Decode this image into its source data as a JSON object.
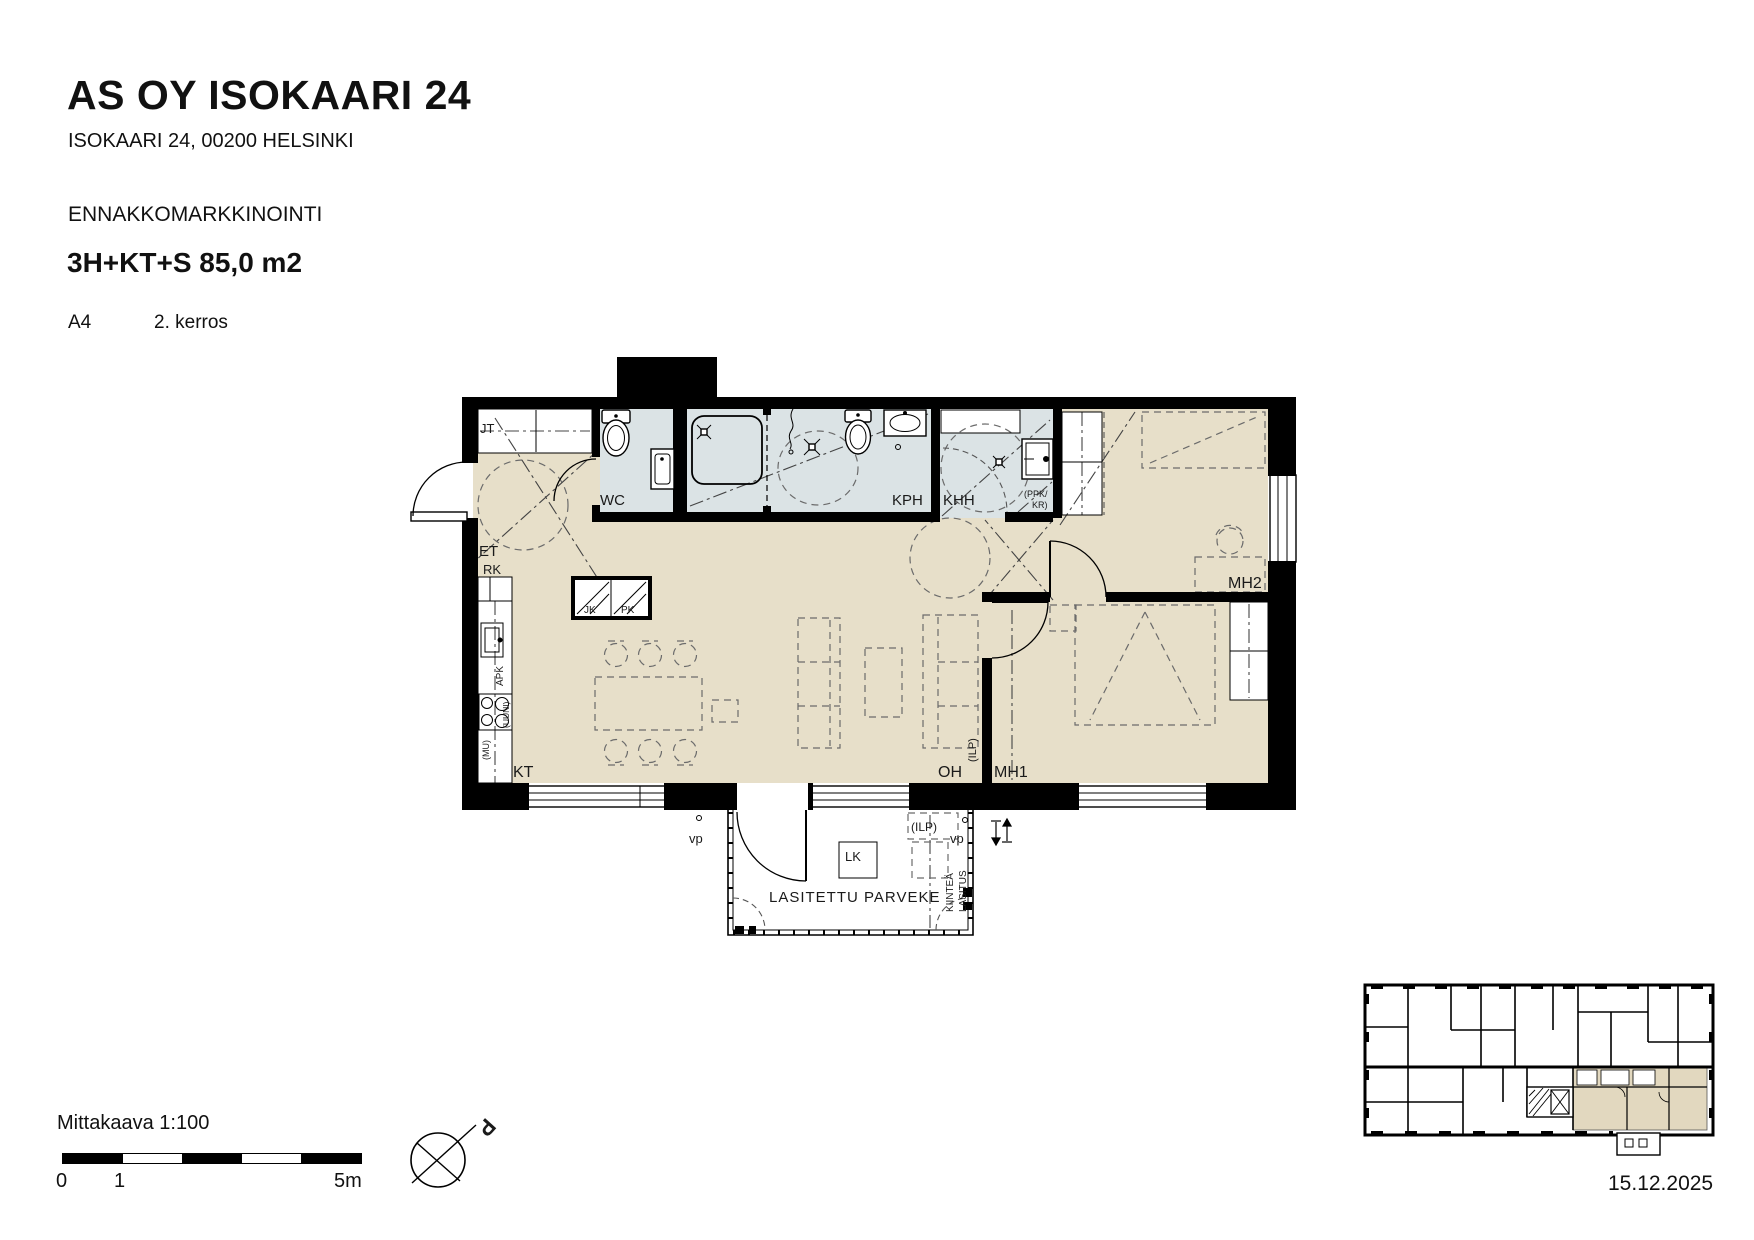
{
  "header": {
    "title": "AS OY ISOKAARI 24",
    "address": "ISOKAARI 24, 00200 HELSINKI",
    "marketing_status": "ENNAKKOMARKKINOINTI",
    "apartment_type": "3H+KT+S 85,0 m2",
    "unit": "A4",
    "floor": "2. kerros"
  },
  "plan": {
    "labels": {
      "jt": "JT",
      "wc": "WC",
      "kph": "KPH",
      "khh": "KHH",
      "ppk_kr_line1": "(PPK/",
      "ppk_kr_line2": "KR)",
      "et": "ET",
      "rk": "RK",
      "jk": "JK",
      "pk": "PK",
      "apk": "APK",
      "uuni": "(UUNI)",
      "mu": "(MU)",
      "kt": "KT",
      "oh": "OH",
      "mh1": "MH1",
      "mh2": "MH2",
      "ilp": "(ILP)",
      "vp": "vp",
      "lk": "LK",
      "glazed_balcony": "LASITETTU PARVEKE",
      "fixed_glazing_line1": "KIINTEÄ",
      "fixed_glazing_line2": "LASITUS"
    }
  },
  "footer": {
    "scale_label": "Mittakaava 1:100",
    "scale_tick_0": "0",
    "scale_tick_1": "1",
    "scale_tick_5": "5m",
    "compass_label": "P",
    "date": "15.12.2025"
  },
  "colors": {
    "floor_dry": "#e7dfc9",
    "floor_wet": "#dbe3e5",
    "wall": "#000000"
  }
}
